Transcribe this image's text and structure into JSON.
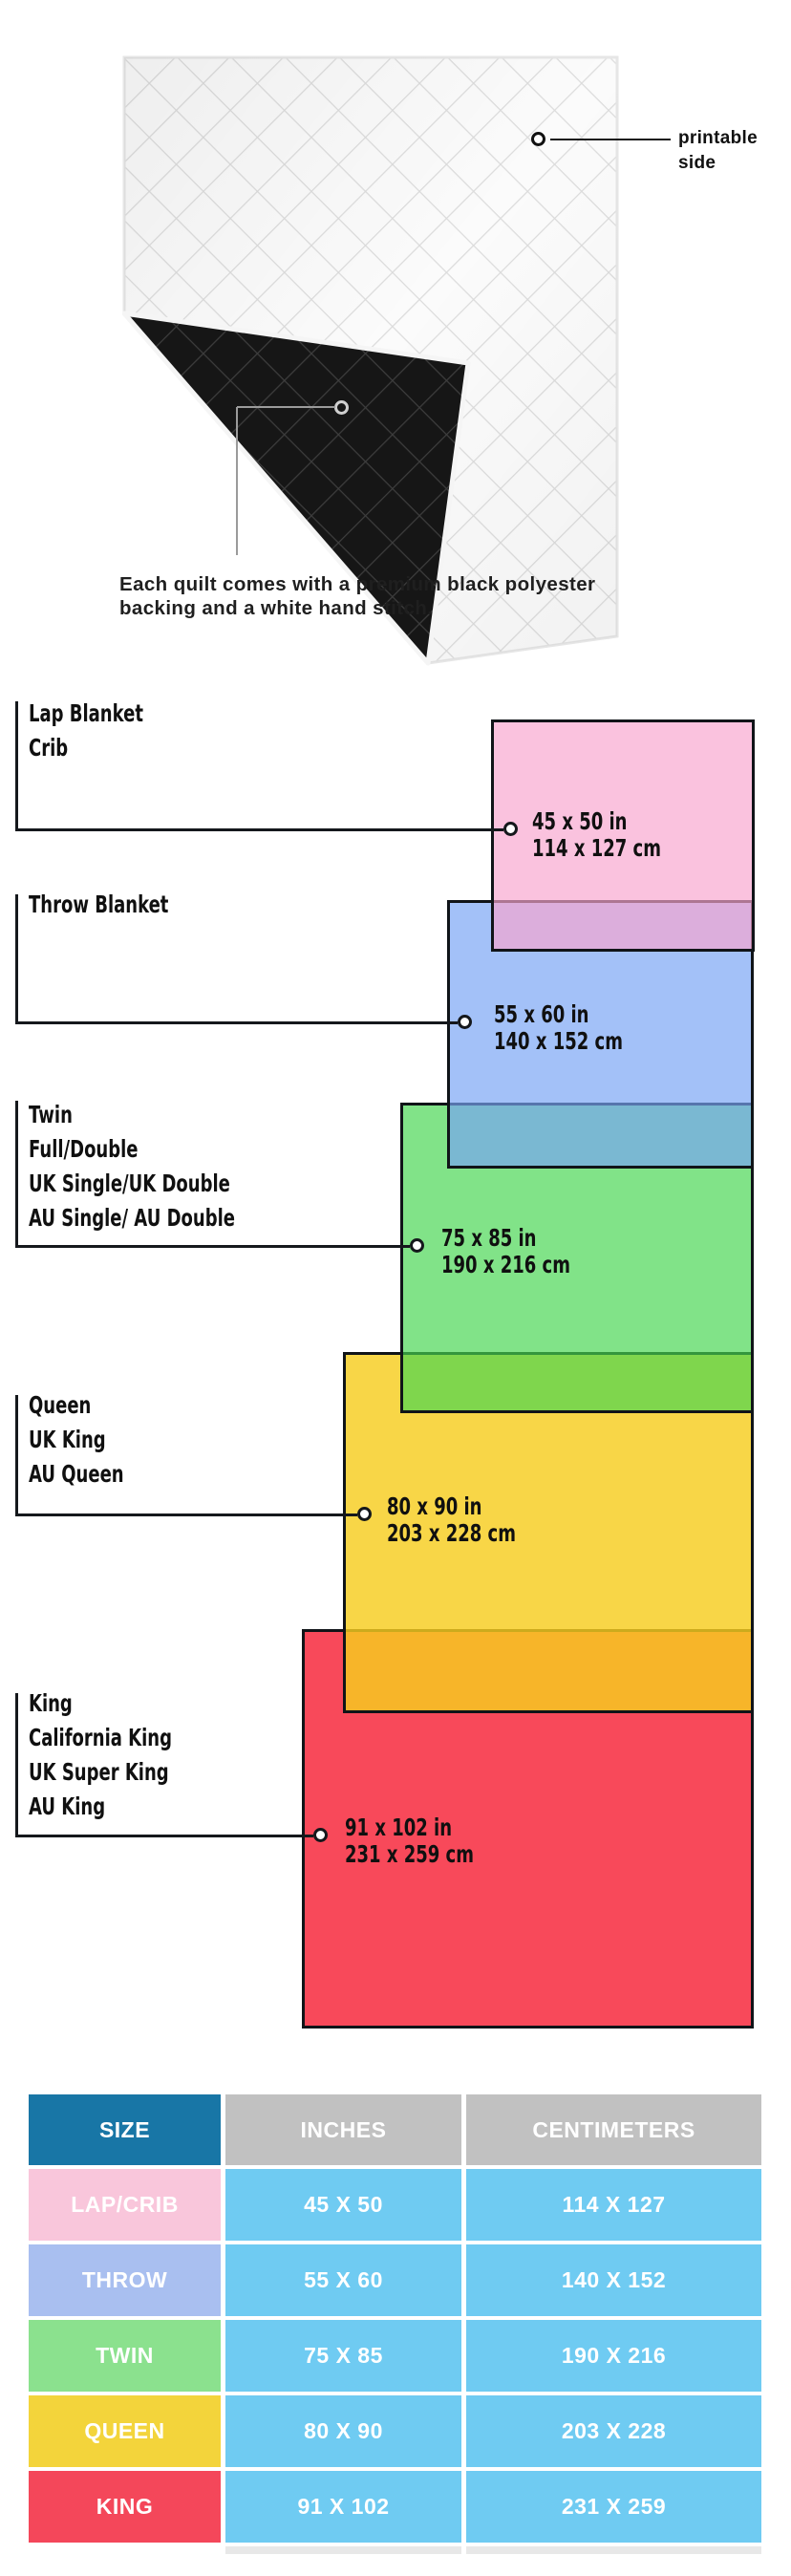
{
  "quilt": {
    "printable_label": "printable side",
    "caption_lines": [
      "Each quilt comes with a premium black polyester",
      "backing and a white hand stitch."
    ],
    "front_color": "#fbfbfb",
    "backing_color": "#161616"
  },
  "diagram": {
    "sizes": [
      {
        "key": "lap-crib",
        "labels": [
          "Lap Blanket",
          "Crib"
        ],
        "inches": "45 x 50 in",
        "centimeters": "114 x 127 cm",
        "fill": "rgba(247,165,206,0.68)"
      },
      {
        "key": "throw",
        "labels": [
          "Throw Blanket"
        ],
        "inches": "55 x 60 in",
        "centimeters": "140 x 152 cm",
        "fill": "rgba(120,163,245,0.68)"
      },
      {
        "key": "twin",
        "labels": [
          "Twin",
          "Full/Double",
          "UK Single/UK Double",
          "AU Single/ AU Double"
        ],
        "inches": "75 x 85 in",
        "centimeters": "190 x 216 cm",
        "fill": "rgba(70,213,80,0.68)"
      },
      {
        "key": "queen",
        "labels": [
          "Queen",
          "UK King",
          "AU Queen"
        ],
        "inches": "80 x 90 in",
        "centimeters": "203 x 228 cm",
        "fill": "rgba(246,205,30,0.82)"
      },
      {
        "key": "king",
        "labels": [
          "King",
          "California King",
          "UK Super King",
          "AU King"
        ],
        "inches": "91 x 102 in",
        "centimeters": "231 x 259 cm",
        "fill": "#f8495a"
      }
    ]
  },
  "table": {
    "headers": [
      "SIZE",
      "INCHES",
      "CENTIMETERS"
    ],
    "header_size_bg": "#1876a6",
    "header_metric_bg": "#c1c1c1",
    "cell_bg": "#6fcbf2",
    "rows": [
      {
        "size": "LAP/CRIB",
        "inches": "45 X 50",
        "centimeters": "114 X 127",
        "color": "#f9c6db"
      },
      {
        "size": "THROW",
        "inches": "55 X 60",
        "centimeters": "140 X 152",
        "color": "#a9bff0"
      },
      {
        "size": "TWIN",
        "inches": "75 X 85",
        "centimeters": "190 X 216",
        "color": "#8be18e"
      },
      {
        "size": "QUEEN",
        "inches": "80 X 90",
        "centimeters": "203 X 228",
        "color": "#f3d43b"
      },
      {
        "size": "KING",
        "inches": "91 X 102",
        "centimeters": "231 X 259",
        "color": "#f4475a"
      }
    ]
  }
}
